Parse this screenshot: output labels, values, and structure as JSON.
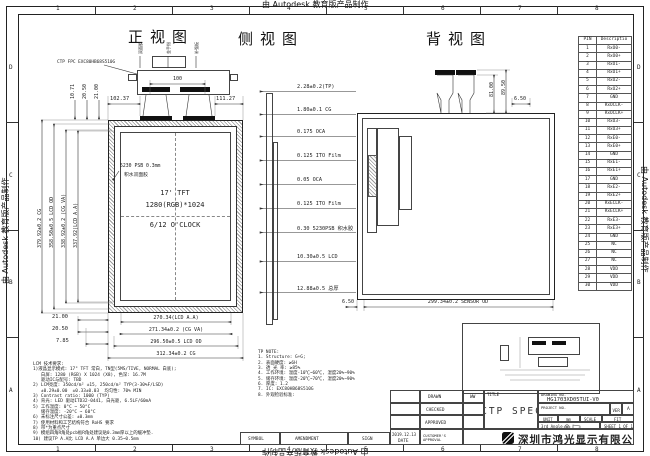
{
  "sheet": {
    "watermark": "由 Autodesk 教育版产品制作",
    "columns": [
      "1",
      "2",
      "3",
      "4",
      "5",
      "6",
      "7",
      "8"
    ],
    "rows": [
      "D",
      "C",
      "B",
      "A"
    ]
  },
  "front_view": {
    "title": "正视图",
    "fpc_label": "CTP FPC EXC80HB68S510G",
    "fpc_tags": [
      "双面胶",
      "金手指",
      "补强板"
    ],
    "adhesive_note": [
      "5230 PSB 0.3mm",
      "积水双面胶"
    ],
    "panel_text": [
      "17'  TFT",
      "1280(RGB)*1024",
      "6/12 O'CLOCK"
    ],
    "dims": {
      "top_v1": "10.71",
      "top_v2": "20.50",
      "top_v3": "21.00",
      "top_left": "102.37",
      "top_right": "111.27",
      "fpc_width": "100",
      "left_v1": "379.92±0.2 CG",
      "left_v2": "358.50±0.5 LCD OD",
      "left_v3": "338.92±0.2 (CG VA)",
      "left_v4": "337.92(LCD A.A)",
      "bottom_s1": "21.00",
      "bottom_s2": "20.50",
      "bottom_s3": "7.85",
      "bottom_1": "270.34(LCD A.A)",
      "bottom_2": "271.34±0.2 (CG VA)",
      "bottom_3": "296.50±0.5 LCD OD",
      "bottom_4": "312.34±0.2 CG"
    }
  },
  "side_view": {
    "title": "侧视图",
    "stack": [
      "2.28±0.2(TP)",
      "1.80±0.1 CG",
      "0.175 OCA",
      "0.125 ITO Film",
      "0.05 OCA",
      "0.125 ITO Film",
      "0.30 5230PSB 积水胶",
      "10.30±0.5 LCD",
      "12.88±0.5 总厚"
    ]
  },
  "back_view": {
    "title": "背视图",
    "dims": {
      "tab_h1": "81.00",
      "tab_h2": "89.50",
      "top_right": "6.50",
      "bottom_left": "6.50",
      "bottom_od": "299.34±0.2 SENSOR OD"
    }
  },
  "pin_table": {
    "headers": [
      "PIN",
      "Descriptio"
    ],
    "pins": [
      [
        "1",
        "RxO0-"
      ],
      [
        "2",
        "RxO0+"
      ],
      [
        "3",
        "RxO1-"
      ],
      [
        "4",
        "RxO1+"
      ],
      [
        "5",
        "RxO2-"
      ],
      [
        "6",
        "RxO2+"
      ],
      [
        "7",
        "GND"
      ],
      [
        "8",
        "RxOCLK-"
      ],
      [
        "9",
        "RxOCLK+"
      ],
      [
        "10",
        "RxO3-"
      ],
      [
        "11",
        "RxO3+"
      ],
      [
        "12",
        "RxE0-"
      ],
      [
        "13",
        "RxE0+"
      ],
      [
        "14",
        "GND"
      ],
      [
        "15",
        "RxE1-"
      ],
      [
        "16",
        "RxE1+"
      ],
      [
        "17",
        "GND"
      ],
      [
        "18",
        "RxE2-"
      ],
      [
        "19",
        "RxE2+"
      ],
      [
        "20",
        "RxECLK-"
      ],
      [
        "21",
        "RxECLK+"
      ],
      [
        "22",
        "RxE3-"
      ],
      [
        "23",
        "RxE3+"
      ],
      [
        "24",
        "GND"
      ],
      [
        "25",
        "NC"
      ],
      [
        "26",
        "NC"
      ],
      [
        "27",
        "NC"
      ],
      [
        "28",
        "VDD"
      ],
      [
        "29",
        "VDD"
      ],
      [
        "30",
        "VDD"
      ]
    ]
  },
  "lcm_notes": [
    "LCM 技术要求:",
    "1)液晶显示模式: 17\" TFT 常白, TN型(5MS/TIVE, NORMAL 白底);",
    "   白屏: 1280 (RGB) X 1024 (X8), 色深: 16.7M",
    "   驱动IC与配号: TBD",
    "2) LCM亮度: 350cd/m² ±15, 250cd/m² TYP(3-30%F/LSD)",
    "   ±0.29±0.00  ±0.33±0.03  均匀性: 70% MIN",
    "3) Contrast ratio: 1000 (TYP)",
    "4) 背光: LED 驱动ITD32-0441, 白光驱, 6.5LF/60mA",
    "5) 工作温度: 0°C ~ 50°C",
    "   储存温度: -20°C ~ 60°C",
    "6) 未标注尺寸公差: ±0.3mm",
    "7) 使用材料和工艺结构符合 RoHS 要求",
    "8) 带*为重点尺寸",
    "9) 模组四角R角处pcb板R角处建议贴0.3mm厚以上的缓冲垫.",
    "10) 建议TP A.A比 LCD A.A 单边大 0.35~0.5mm"
  ],
  "tp_notes": [
    "TP NOTE:",
    "1. Structure: G+G;",
    "2. 表面硬度: ≥6H",
    "3. 透 光 率: ≥85%",
    "4. 工作环境: 温度-10℃~60℃, 湿度20%~90%",
    "5. 储存环境: 温度-20℃~70℃, 湿度20%~90%",
    "6. 厚度: 1.2",
    "7. IC: EXC80HB68S510G",
    "8. 外观检验标准:"
  ],
  "title_block": {
    "drawn_label": "DRAWN",
    "drawn_value": "WW",
    "checked_label": "CHECKED",
    "approved_label": "APPROVED",
    "customer_label": "CUSTOMER'S APPROVAL",
    "date_value": "2019.12.13",
    "date_label": "DATE",
    "title_label": "TITLE",
    "title_value": "CTP SPEC",
    "drawing_no_label": "DRAWING NO.",
    "drawing_no_value": "HG1703XD05TUI-V0",
    "project_no_label": "PROJECT NO.",
    "ver_label": "VER",
    "ver_value": "A",
    "unit_label": "UNIT",
    "unit_value": "mm",
    "scale_label": "SCALE",
    "scale_value": "FIT",
    "angle_label": "3rd Angle",
    "sheet_label": "SHEET 1 OF 1",
    "company": "深圳市鸿光显示有限公司"
  },
  "amendment": {
    "symbol": "SYMBOL",
    "amendment": "AMENDMENT",
    "sign": "SIGN"
  }
}
